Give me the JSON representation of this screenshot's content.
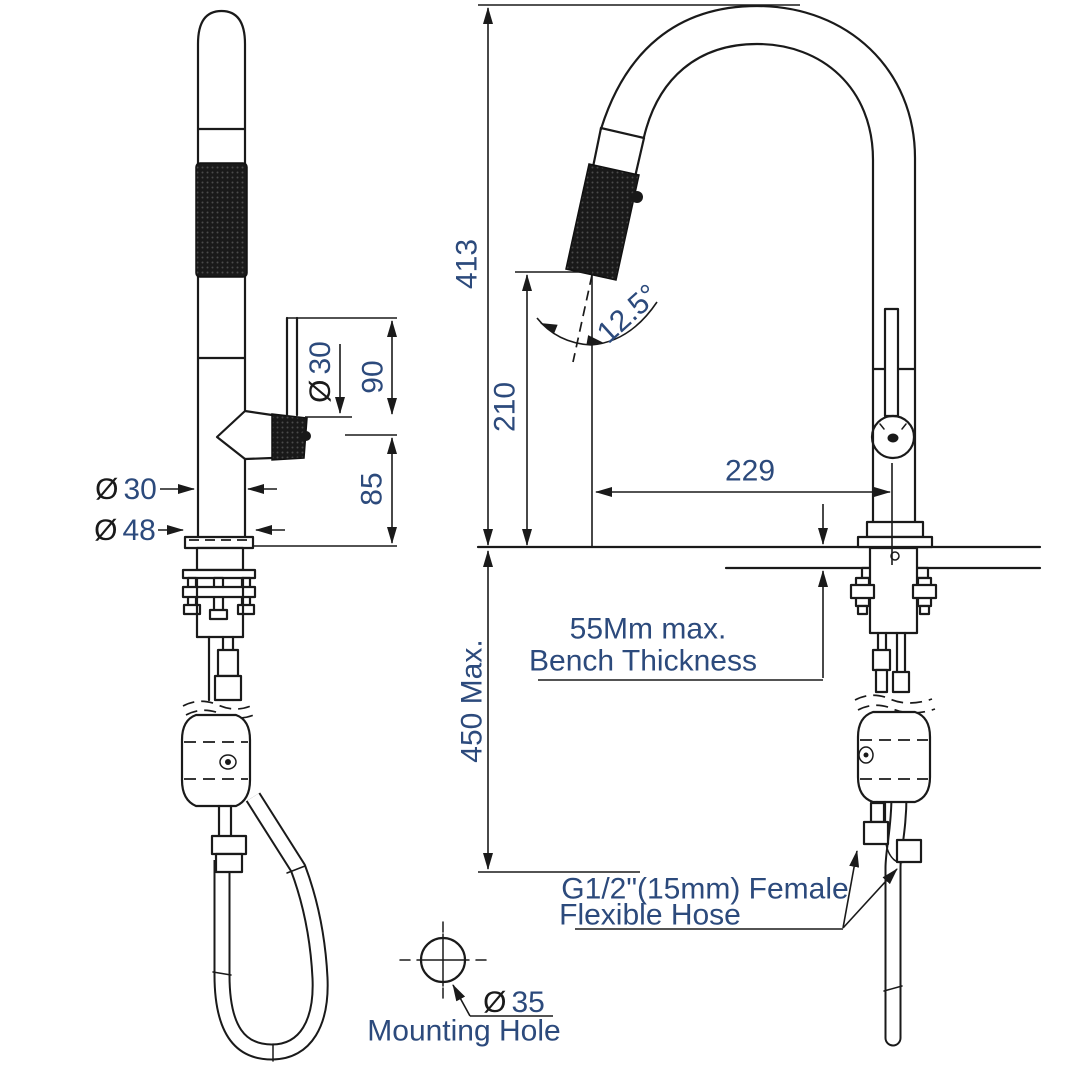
{
  "symbols": {
    "diameter": "Ø"
  },
  "left_view": {
    "dim_90": "90",
    "dim_85": "85",
    "dia_30_side": "30",
    "dia_30": "30",
    "dia_48": "48"
  },
  "right_view": {
    "dim_413": "413",
    "dim_210": "210",
    "dim_229": "229",
    "angle_12_5": "12.5°",
    "dim_450_max": "450 Max.",
    "bench_note_line1": "55Mm max.",
    "bench_note_line2": "Bench Thickness",
    "hose_note_line1": "G1/2\"(15mm) Female",
    "hose_note_line2": "Flexible Hose"
  },
  "mounting_hole_detail": {
    "dia_35": "35",
    "label": "Mounting Hole"
  },
  "colors": {
    "line": "#1a1a1a",
    "dimension_text": "#2c4a7c",
    "knurl_fill": "#191919",
    "background": "#ffffff"
  }
}
